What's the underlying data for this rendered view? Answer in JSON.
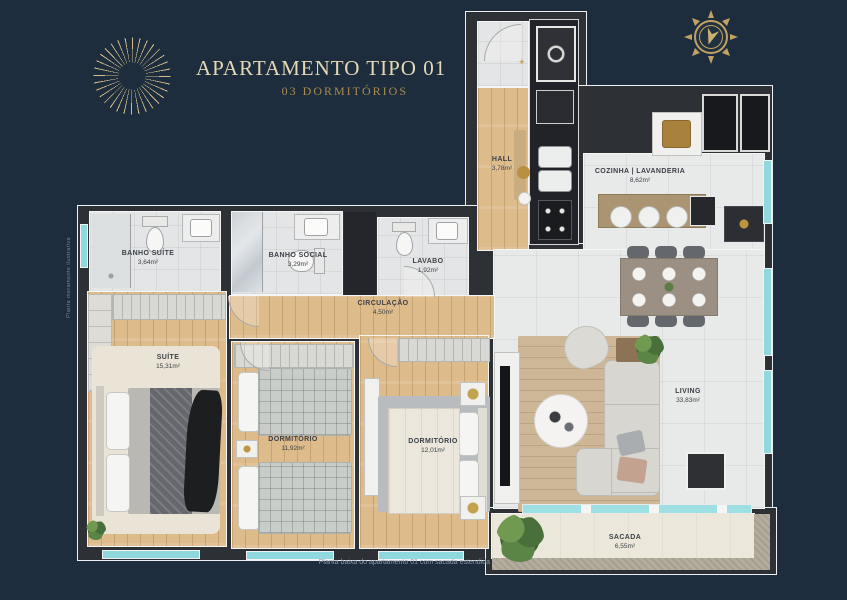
{
  "header": {
    "title": "APARTAMENTO TIPO 01",
    "subtitle": "03 DORMITÓRIOS"
  },
  "footnote": "Planta baixa do apartamento 01 com sacada estendida",
  "side_note": "Planta meramente ilustrativa",
  "rooms": [
    {
      "name": "hall",
      "label": "HALL",
      "area": "3,78m²"
    },
    {
      "name": "cozinha-lavanderia",
      "label": "COZINHA | LAVANDERIA",
      "area": "8,62m²"
    },
    {
      "name": "banho-suite",
      "label": "BANHO SUÍTE",
      "area": "3,64m²"
    },
    {
      "name": "banho-social",
      "label": "BANHO SOCIAL",
      "area": "3,29m²"
    },
    {
      "name": "lavabo",
      "label": "LAVABO",
      "area": "1,92m²"
    },
    {
      "name": "circulacao",
      "label": "CIRCULAÇÃO",
      "area": "4,50m²"
    },
    {
      "name": "suite",
      "label": "SUÍTE",
      "area": "15,31m²"
    },
    {
      "name": "dormitorio-1",
      "label": "DORMITÓRIO",
      "area": "11,92m²"
    },
    {
      "name": "dormitorio-2",
      "label": "DORMITÓRIO",
      "area": "12,01m²"
    },
    {
      "name": "living",
      "label": "LIVING",
      "area": "33,83m²"
    },
    {
      "name": "sacada",
      "label": "SACADA",
      "area": "6,55m²"
    }
  ],
  "colors": {
    "background": "#1e2d3d",
    "accent_gold": "#c2a262",
    "title_cream": "#e5d8b5",
    "wall": "#2d3035",
    "wood_floor": "#debb8b",
    "tile_floor": "#e8e9e9",
    "balcony_floor": "#ebe7da",
    "window_glass": "#8fd9de",
    "label_text": "#3c4147"
  }
}
